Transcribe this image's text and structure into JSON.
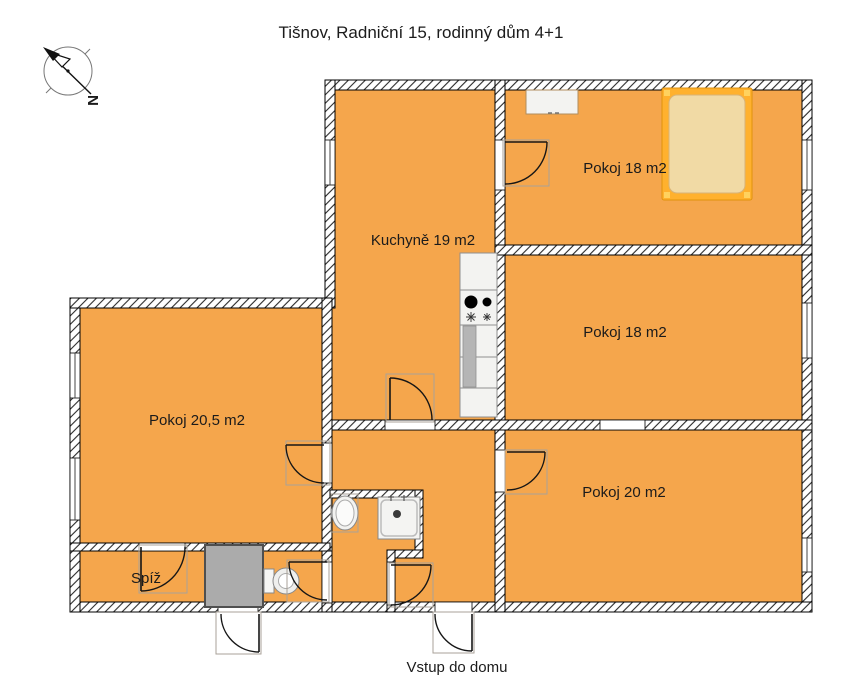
{
  "title": "Tišnov, Radniční 15, rodinný dům 4+1",
  "compass": {
    "label": "N"
  },
  "rooms": [
    {
      "id": "kitchen",
      "label": "Kuchyně 19 m2"
    },
    {
      "id": "room-top",
      "label": "Pokoj 18 m2"
    },
    {
      "id": "room-middle",
      "label": "Pokoj 18 m2"
    },
    {
      "id": "room-bottom",
      "label": "Pokoj 20 m2"
    },
    {
      "id": "room-left",
      "label": "Pokoj 20,5 m2"
    },
    {
      "id": "pantry",
      "label": "Spíž"
    }
  ],
  "entrance": {
    "label": "Vstup do domu"
  },
  "colors": {
    "floor": "#F5A64C",
    "bed_frame": "#FFB12E",
    "bed_mattress": "#F1DAA5",
    "gray_block": "#ABABAB",
    "fixture": "#F3F3F1"
  }
}
